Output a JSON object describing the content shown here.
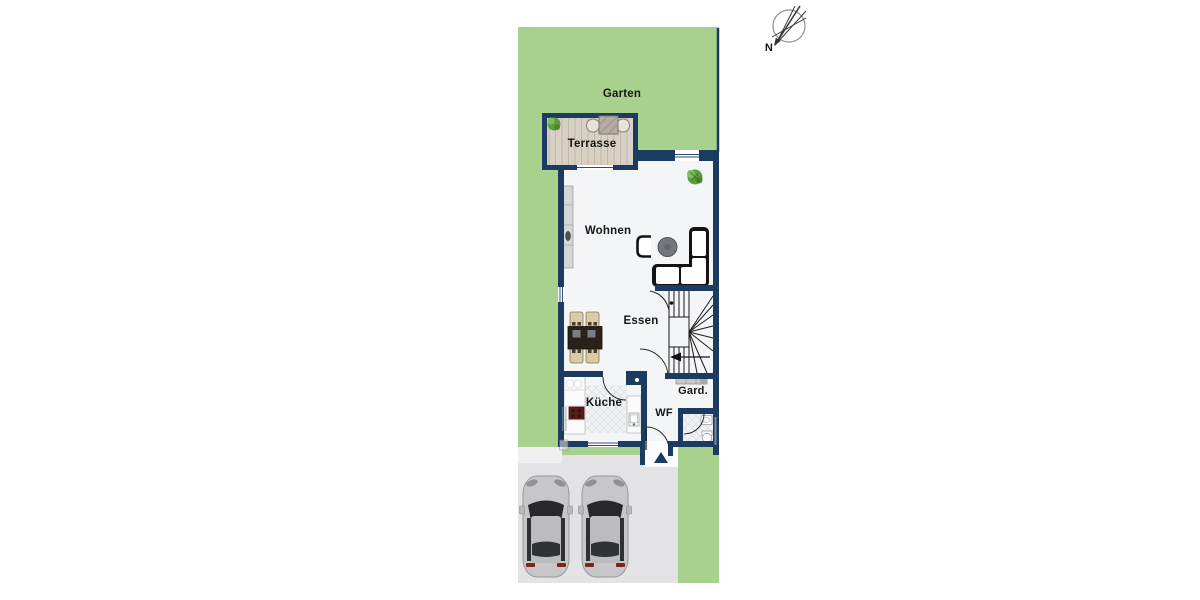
{
  "floorplan": {
    "rooms": {
      "garten": "Garten",
      "terrasse": "Terrasse",
      "wohnen": "Wohnen",
      "essen": "Essen",
      "kueche": "Küche",
      "wf": "WF",
      "gard": "Gard."
    },
    "compass": {
      "north": "N"
    },
    "colors": {
      "garden": "#a9d18e",
      "wall": "#1b3b60",
      "floor": "#f4f5f7",
      "terrace-wood": "#d8cfc5",
      "plank-line": "#c2b7aa",
      "parking": "#e3e3e5",
      "tile-bg": "#f0f2f4",
      "tile-line": "#d8dce0",
      "car-body": "#c7c7c9",
      "stove": "#681811",
      "sofa": "#141414",
      "plant": "#5f9e3f"
    }
  }
}
